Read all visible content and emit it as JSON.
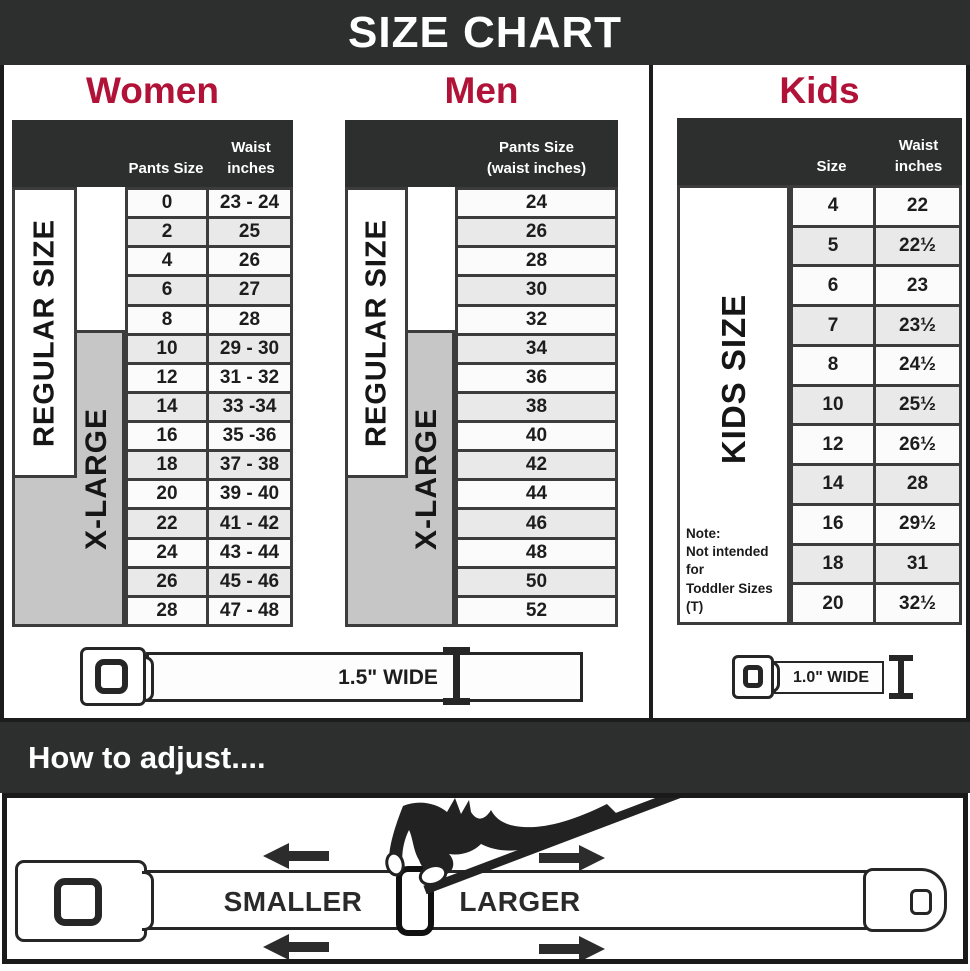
{
  "page": {
    "title": "SIZE CHART"
  },
  "colors": {
    "accent": "#b11237",
    "dark": "#2d2e2e",
    "band_gray": "#c6c6c6"
  },
  "sections": {
    "women": {
      "title": "Women",
      "header": {
        "col1": "Pants Size",
        "col2_line1": "Waist",
        "col2_line2": "inches"
      },
      "bands": {
        "regular": "REGULAR SIZE",
        "xlarge": "X-LARGE"
      },
      "rows": [
        {
          "size": "0",
          "waist": "23 - 24"
        },
        {
          "size": "2",
          "waist": "25"
        },
        {
          "size": "4",
          "waist": "26"
        },
        {
          "size": "6",
          "waist": "27"
        },
        {
          "size": "8",
          "waist": "28"
        },
        {
          "size": "10",
          "waist": "29 - 30"
        },
        {
          "size": "12",
          "waist": "31 - 32"
        },
        {
          "size": "14",
          "waist": "33 -34"
        },
        {
          "size": "16",
          "waist": "35 -36"
        },
        {
          "size": "18",
          "waist": "37 - 38"
        },
        {
          "size": "20",
          "waist": "39 - 40"
        },
        {
          "size": "22",
          "waist": "41 - 42"
        },
        {
          "size": "24",
          "waist": "43 - 44"
        },
        {
          "size": "26",
          "waist": "45 - 46"
        },
        {
          "size": "28",
          "waist": "47 - 48"
        }
      ],
      "belt_label": "1.5\" WIDE"
    },
    "men": {
      "title": "Men",
      "header": {
        "line1": "Pants Size",
        "line2": "(waist inches)"
      },
      "bands": {
        "regular": "REGULAR SIZE",
        "xlarge": "X-LARGE"
      },
      "rows": [
        "24",
        "26",
        "28",
        "30",
        "32",
        "34",
        "36",
        "38",
        "40",
        "42",
        "44",
        "46",
        "48",
        "50",
        "52"
      ]
    },
    "kids": {
      "title": "Kids",
      "header": {
        "col1": "Size",
        "col2_line1": "Waist",
        "col2_line2": "inches"
      },
      "band": "KIDS SIZE",
      "note_line1": "Note:",
      "note_line2": "Not intended for",
      "note_line3": "Toddler Sizes (T)",
      "rows": [
        {
          "size": "4",
          "waist": "22"
        },
        {
          "size": "5",
          "waist": "22½"
        },
        {
          "size": "6",
          "waist": "23"
        },
        {
          "size": "7",
          "waist": "23½"
        },
        {
          "size": "8",
          "waist": "24½"
        },
        {
          "size": "10",
          "waist": "25½"
        },
        {
          "size": "12",
          "waist": "26½"
        },
        {
          "size": "14",
          "waist": "28"
        },
        {
          "size": "16",
          "waist": "29½"
        },
        {
          "size": "18",
          "waist": "31"
        },
        {
          "size": "20",
          "waist": "32½"
        }
      ],
      "belt_label": "1.0\" WIDE"
    }
  },
  "adjust": {
    "heading": "How to adjust....",
    "smaller": "SMALLER",
    "larger": "LARGER"
  }
}
